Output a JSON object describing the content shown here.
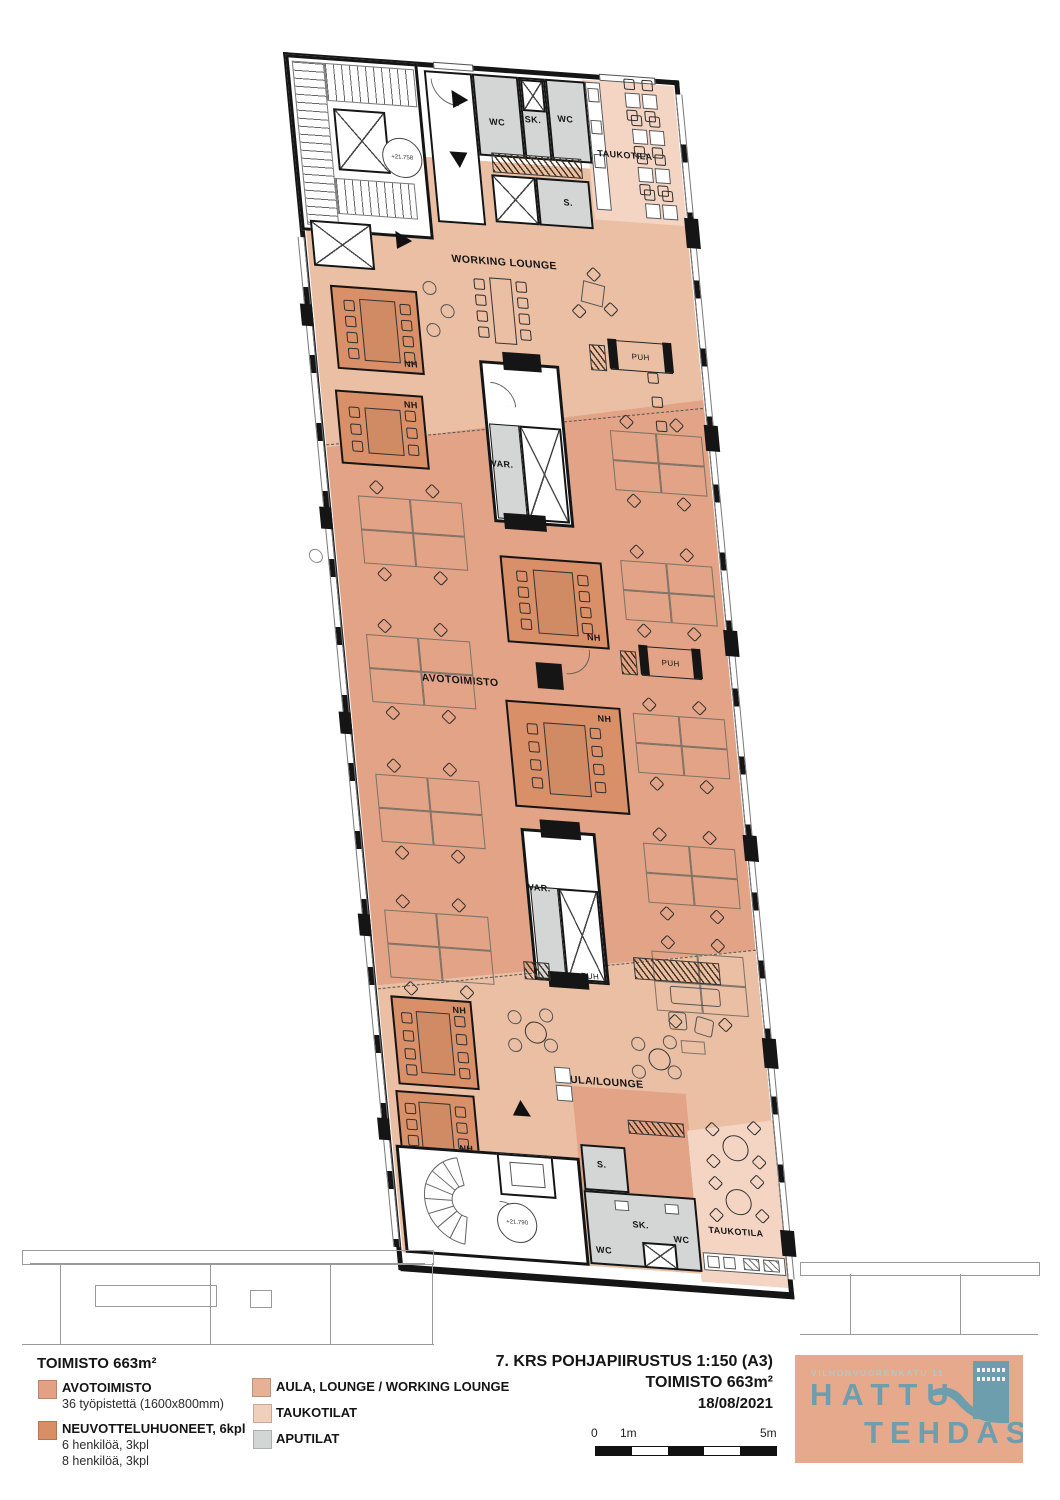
{
  "plan": {
    "labels": {
      "wc": "WC",
      "sk": "SK.",
      "s": "S.",
      "taukotila": "TAUKOTILA",
      "working_lounge": "WORKING LOUNGE",
      "nh": "NH",
      "var": "VAR.",
      "avotoimisto": "AVOTOIMISTO",
      "puh": "PUH",
      "aula_lounge": "AULA/LOUNGE"
    },
    "levels": {
      "top": "+21.758",
      "bottom": "+21.790"
    },
    "colors": {
      "avotoimisto": "#e2a386",
      "neuvotteluhuoneet": "#d99069",
      "aula_lounge_working_lounge": "#eabfa3",
      "taukotilat": "#f4d5c3",
      "aputilat": "#d3d6d5",
      "wall": "#151515"
    }
  },
  "legend": {
    "title": "TOIMISTO  663m²",
    "left": [
      {
        "label": "AVOTOIMISTO",
        "subs": [
          "36 työpistettä (1600x800mm)"
        ]
      },
      {
        "label": "NEUVOTTELUHUONEET, 6kpl",
        "subs": [
          "6 henkilöä, 3kpl",
          "8 henkilöä, 3kpl"
        ]
      }
    ],
    "right": [
      {
        "label": "AULA, LOUNGE / WORKING LOUNGE"
      },
      {
        "label": "TAUKOTILAT"
      },
      {
        "label": "APUTILAT"
      }
    ]
  },
  "titleblock": {
    "line1": "7. KRS POHJAPIIRUSTUS  1:150 (A3)",
    "line2": "TOIMISTO  663m²",
    "line3": "18/08/2021"
  },
  "scalebar": {
    "zero": "0",
    "one": "1m",
    "five": "5m"
  },
  "logo": {
    "address": "VILHONVUORENKATU 11",
    "name1": "HATTU",
    "name2": "TEHDAS",
    "bg": "#e7a98c",
    "fg": "#6d9eae"
  }
}
